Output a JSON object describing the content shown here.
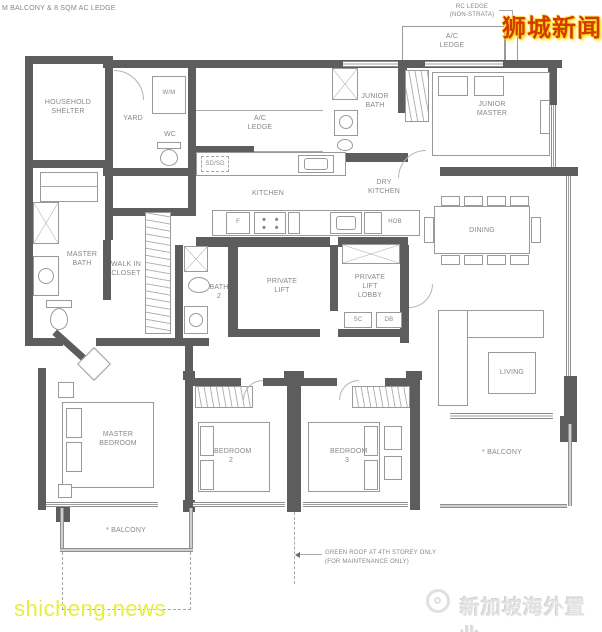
{
  "page": {
    "top_note": "M BALCONY & 8 SQM AC LEDGE"
  },
  "annotations": {
    "rc_ledge_line1": "RC LEDGE",
    "rc_ledge_line2": "(NON-STRATA)",
    "green_roof_line1": "GREEN ROOF AT 4TH STOREY ONLY",
    "green_roof_line2": "(FOR MAINTENANCE ONLY)"
  },
  "rooms": {
    "household_shelter": "HOUSEHOLD SHELTER",
    "yard": "YARD",
    "wc": "WC",
    "ac_ledge_top": "A/C LEDGE",
    "ac_ledge_mid": "A/C LEDGE",
    "junior_bath": "JUNIOR BATH",
    "junior_master": "JUNIOR MASTER",
    "kitchen": "KITCHEN",
    "dry_kitchen": "DRY KITCHEN",
    "dining": "DINING",
    "master_bath": "MASTER BATH",
    "walk_in_closet": "WALK IN CLOSET",
    "bath_2": "BATH 2",
    "private_lift": "PRIVATE LIFT",
    "private_lift_lobby": "PRIVATE LIFT LOBBY",
    "living": "LIVING",
    "master_bedroom": "MASTER BEDROOM",
    "bedroom_2": "BEDROOM 2",
    "bedroom_3": "BEDROOM 3",
    "balcony_right": "* BALCONY",
    "balcony_bottom": "* BALCONY"
  },
  "fixtures": {
    "wm": "W/M",
    "sd": "SD/SD",
    "fridge": "F",
    "hob": "HOB",
    "sc": "SC",
    "db": "DB"
  },
  "watermarks": {
    "top_right": "狮城新闻",
    "bottom_left": "shicheng.news",
    "bottom_right": "新加坡海外置业"
  },
  "colors": {
    "wall": "#5d5d5d",
    "line": "#9a9a9a",
    "label": "#878787",
    "watermark_red": "#d23a00",
    "watermark_yellow": "#e7ee3b",
    "watermark_gray": "#e2e2e2"
  }
}
